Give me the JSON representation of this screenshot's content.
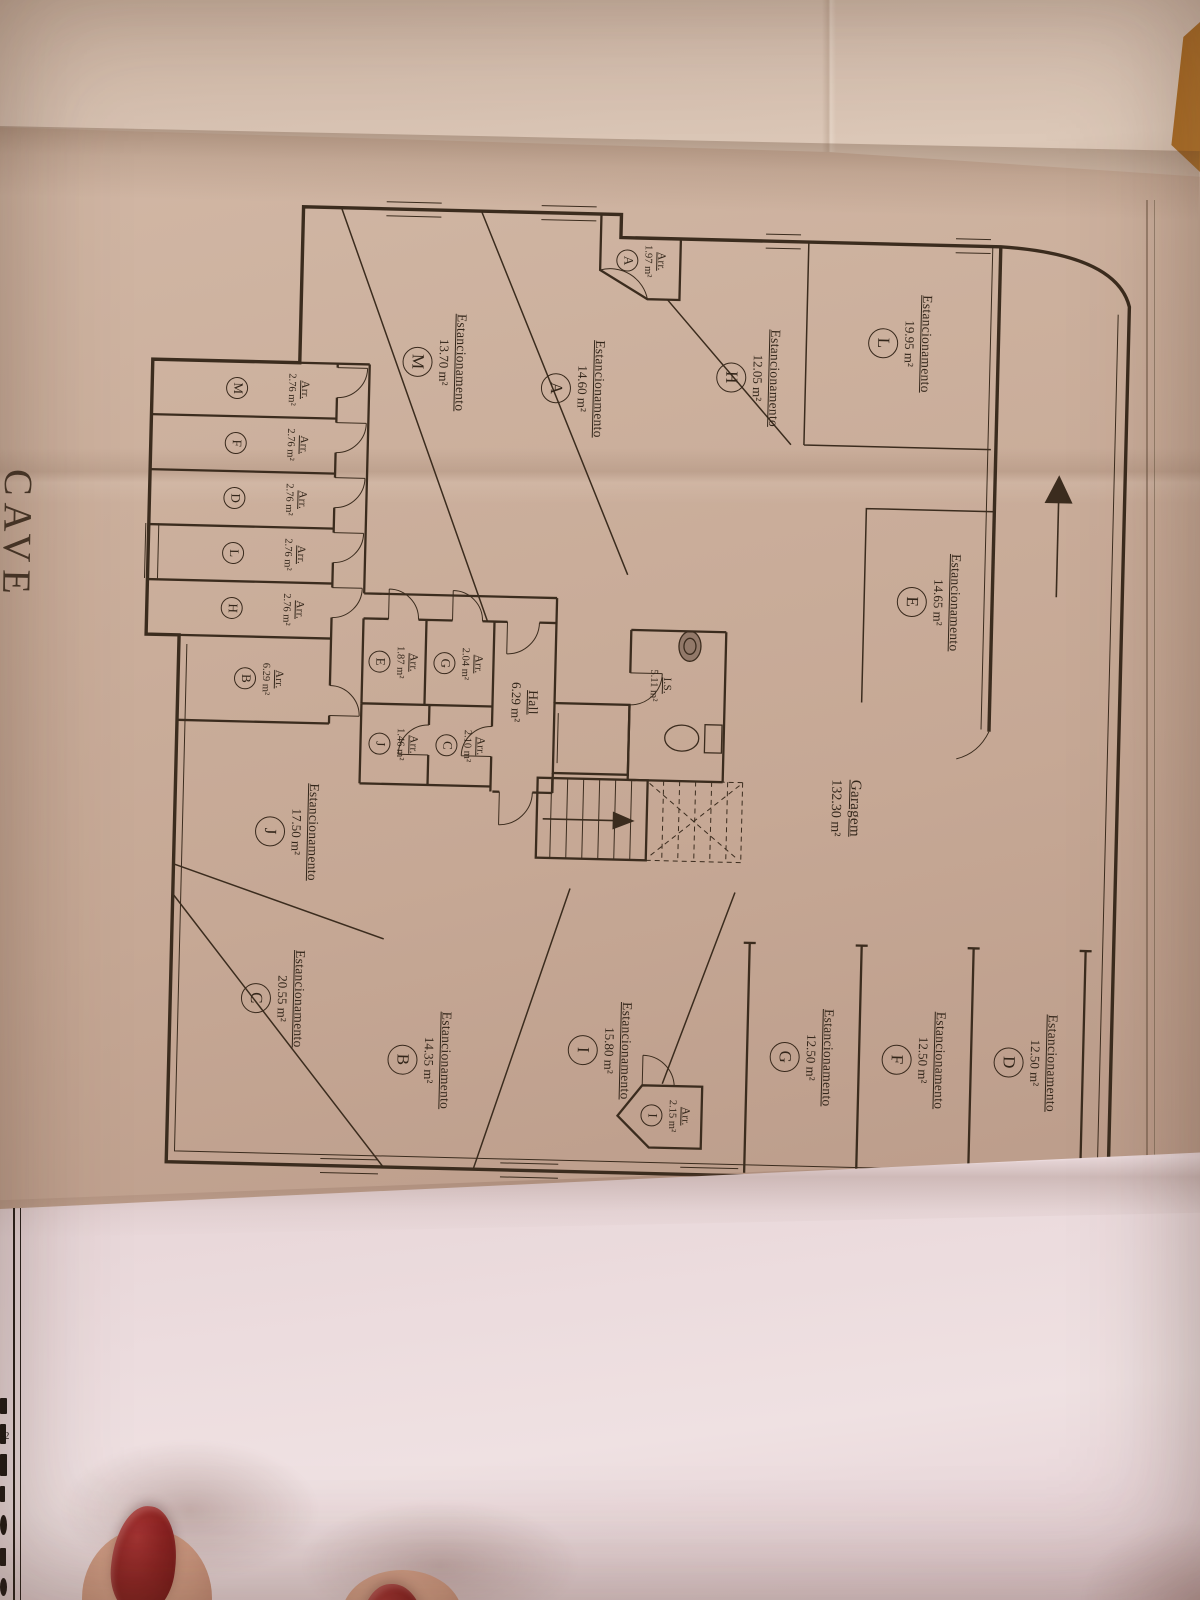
{
  "sheet": {
    "title": "CAVE",
    "page_note": "-2"
  },
  "plan": {
    "labels": {
      "parking": "Estancionamento",
      "storage": "Arr."
    },
    "rooms": {
      "garage": {
        "name": "Garagem",
        "area": "132.30 m²"
      },
      "hall": {
        "name": "Hall",
        "area": "6.29 m²"
      },
      "wc": {
        "name": "I.S.",
        "area": "5.11 m²"
      }
    },
    "parking": [
      {
        "letter": "L",
        "area": "19.95 m²"
      },
      {
        "letter": "H",
        "area": "12.05 m²"
      },
      {
        "letter": "A",
        "area": "14.60 m²"
      },
      {
        "letter": "M",
        "area": "13.70 m²"
      },
      {
        "letter": "E",
        "area": "14.65 m²"
      },
      {
        "letter": "J",
        "area": "17.50 m²"
      },
      {
        "letter": "C",
        "area": "20.55 m²"
      },
      {
        "letter": "B",
        "area": "14.35 m²"
      },
      {
        "letter": "I",
        "area": "15.80 m²"
      },
      {
        "letter": "G",
        "area": "12.50 m²"
      },
      {
        "letter": "F",
        "area": "12.50 m²"
      },
      {
        "letter": "D",
        "area": "12.50 m²"
      }
    ],
    "storage": [
      {
        "letter": "A",
        "area": "1.97 m²"
      },
      {
        "letter": "M",
        "area": "2.76 m²"
      },
      {
        "letter": "F",
        "area": "2.76 m²"
      },
      {
        "letter": "D",
        "area": "2.76 m²"
      },
      {
        "letter": "L",
        "area": "2.76 m²"
      },
      {
        "letter": "H",
        "area": "2.76 m²"
      },
      {
        "letter": "B",
        "area": "6.29 m²"
      },
      {
        "letter": "E",
        "area": "1.87 m²"
      },
      {
        "letter": "G",
        "area": "2.04 m²"
      },
      {
        "letter": "J",
        "area": "1.46 m²"
      },
      {
        "letter": "C",
        "area": "2.10 m²"
      },
      {
        "letter": "I",
        "area": "2.15 m²"
      }
    ]
  }
}
